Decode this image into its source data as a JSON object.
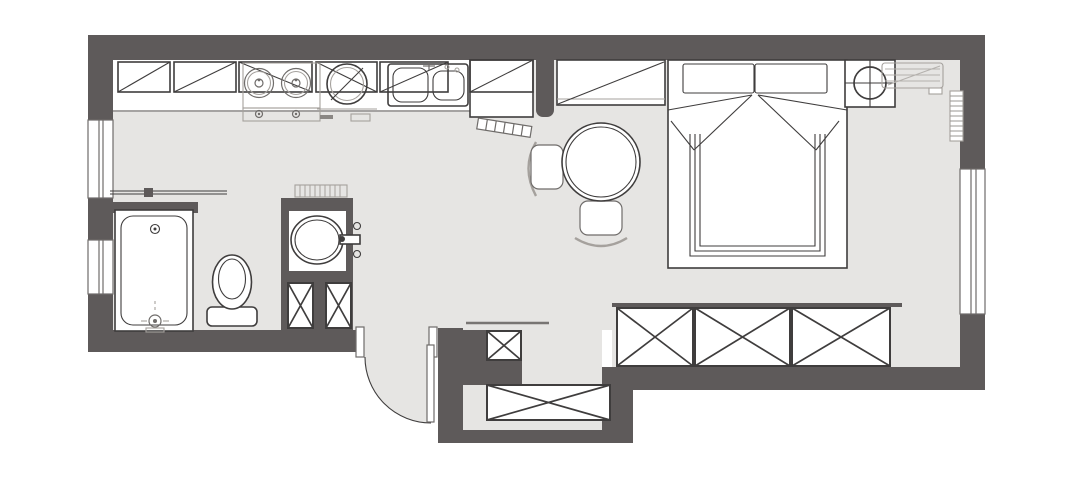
{
  "colors": {
    "wall": "#5e5a5a",
    "floor": "#e6e5e3",
    "outline": "#3f3d3d",
    "outline_mid": "#6f6c6a",
    "outline_light": "#a5a19d",
    "furniture_fill": "#ffffff",
    "paper": "#ffffff"
  },
  "inventory": {
    "kitchen": [
      "upper-cabinets",
      "counter",
      "two-burner-stove",
      "washing-machine",
      "double-sink",
      "folding-door",
      "tall-unit"
    ],
    "bathroom": [
      "bathtub",
      "shower-screen",
      "toilet",
      "vanity-basin",
      "towel-rack",
      "under-vanity-cabinets",
      "half-wall"
    ],
    "bedroom-living": [
      "double-bed",
      "pillows",
      "bedside-table",
      "table-lamp",
      "air-conditioner",
      "radiator",
      "round-dining-table",
      "dining-chairs",
      "entry-closet"
    ],
    "storage": [
      "wardrobe-row",
      "entry-niche-cabinet",
      "shoe-cabinet",
      "coat-shelf"
    ],
    "openings": [
      "entry-door",
      "left-window-upper",
      "left-window-lower",
      "right-window"
    ]
  }
}
